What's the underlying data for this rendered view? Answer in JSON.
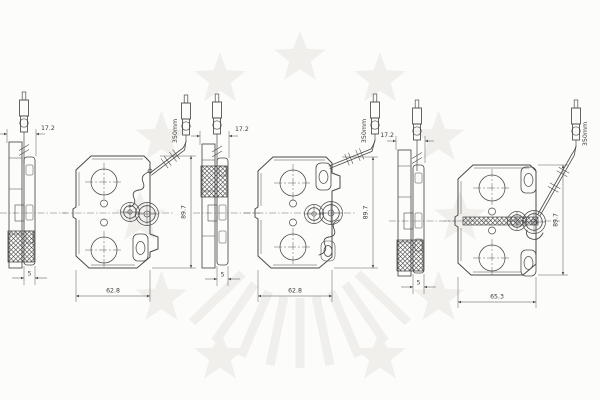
{
  "page": {
    "background": "#fcfcfb"
  },
  "watermark": {
    "name": "star-ring-logo",
    "color": "#f0efec"
  },
  "drawing": {
    "ink": "#4a4a4a",
    "text_color": "#3c3c3c",
    "groups": [
      {
        "id": "left",
        "backing_thickness": "17.2",
        "friction_thickness": "5",
        "pad_width": "62.8",
        "pad_height": "89.7",
        "wire_length": "350mm"
      },
      {
        "id": "middle",
        "backing_thickness": "17.2",
        "friction_thickness": "5",
        "pad_width": "62.8",
        "pad_height": "89.7",
        "wire_length": "350mm"
      },
      {
        "id": "right",
        "backing_thickness": "17.2",
        "friction_thickness": "5",
        "pad_width": "65.3",
        "pad_height": "89.7",
        "wire_length": "350mm"
      }
    ]
  }
}
